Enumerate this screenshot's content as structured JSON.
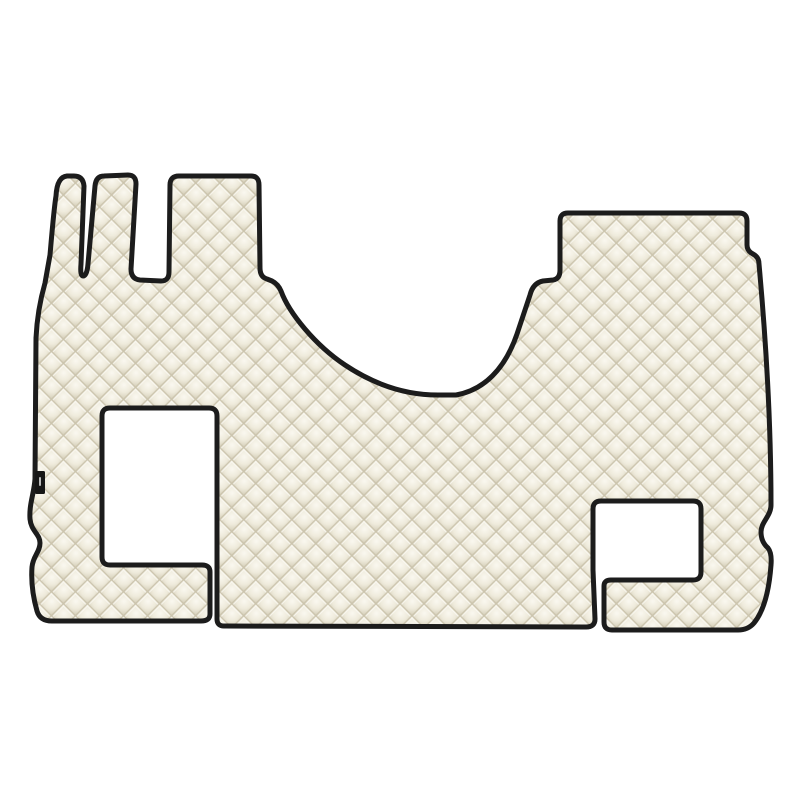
{
  "image": {
    "type": "product-photo",
    "subject": "Cream diamond-quilted eco-leather truck cab floor mat with black piped edges, two rectangular cut-outs for the seat bases, three narrow tabs at the top left, a raised panel at the top right, a curved engine-tunnel recess in the top middle, and a small black brand tag on the left edge",
    "visible_text": "none",
    "pattern": "diamond-quilted",
    "cutouts": [
      "large rectangular cut-out on the left side with a narrow slit to the bottom edge",
      "smaller rectangular cut-out on the right side with a narrow slit to the bottom edge"
    ],
    "colors": {
      "background": "#ffffff",
      "mat_base": "#f1ede0",
      "quilt_highlight": "#faf8f0",
      "quilt_mid": "#efebdc",
      "quilt_shadow": "#d8d2bd",
      "stitch": "#c9c2ab",
      "stitch_highlight": "#fdfcf8",
      "piping": "#1c1c1c",
      "tag": "#161616",
      "tag_mark": "#d8d8d8"
    }
  }
}
